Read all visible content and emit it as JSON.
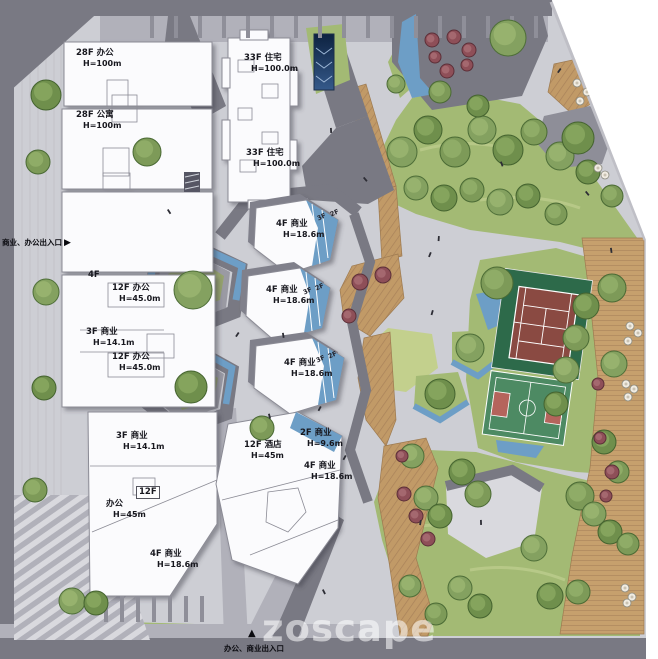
{
  "watermark": "zoscape",
  "entrances": {
    "left": "商业、办公出入口",
    "left_arrow": "▶",
    "bottom_arrow": "▲",
    "bottom": "办公、商业出入口"
  },
  "labels": [
    {
      "text": "28F 办公",
      "sub": "H=100m"
    },
    {
      "text": "28F 公寓",
      "sub": "H=100m"
    },
    {
      "text": "33F 住宅",
      "sub": "H=100.0m"
    },
    {
      "text": "33F 住宅",
      "sub": "H=100.0m"
    },
    {
      "text": "4F",
      "sub": ""
    },
    {
      "text": "12F 办公",
      "sub": "H=45.0m"
    },
    {
      "text": "3F 商业",
      "sub": "H=14.1m"
    },
    {
      "text": "12F 办公",
      "sub": "H=45.0m"
    },
    {
      "text": "4F 商业",
      "sub": "H=18.6m"
    },
    {
      "text": "4F 商业",
      "sub": "H=18.6m"
    },
    {
      "text": "4F 商业",
      "sub": "H=18.6m"
    },
    {
      "text": "3F 商业",
      "sub": "H=14.1m"
    },
    {
      "text": "12F",
      "sub": ""
    },
    {
      "text": "办公",
      "sub": "H=45m"
    },
    {
      "text": "12F 酒店",
      "sub": "H=45m"
    },
    {
      "text": "2F 商业",
      "sub": "H=9.6m"
    },
    {
      "text": "4F 商业",
      "sub": "H=18.6m"
    },
    {
      "text": "4F 商业",
      "sub": "H=18.6m"
    }
  ],
  "terrace": {
    "f3": "3F",
    "f2": "2F"
  },
  "colors": {
    "water": "#6d9ec6",
    "lawn": "#a3ba74",
    "lawn_light": "#c3d08d",
    "deck": "#c19a67",
    "deck_stripe": "#a9825a",
    "road_dark": "#797983",
    "road_mid": "#b1b1ba",
    "plaza": "#cdced4",
    "building": "#fbfbfd",
    "building_stroke": "#8b8b95",
    "tennis_pad": "#2d6a4a",
    "court_red": "#8a4a42",
    "bball_pad": "#4d8a63",
    "key_red": "#b5645c",
    "tree_green": "#7b9c55",
    "tree_red": "#8e4f58"
  }
}
